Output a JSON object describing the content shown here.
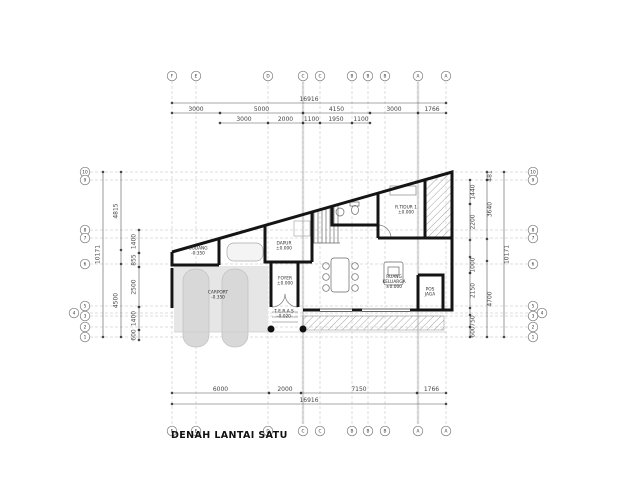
{
  "title": "DENAH LANTAI SATU",
  "colors": {
    "wall": "#141414",
    "dim": "#555555",
    "grid": "#bbbbbb",
    "axis_band": "#dcdcdc",
    "hatch": "#9a9a9a",
    "carport_fill": "#e6e6e6",
    "strip_fill": "#d8d8d8",
    "label": "#2b2b2b"
  },
  "grid": {
    "top_circle_y": 76,
    "bottom_circle_y": 431,
    "left_circle_x": 85,
    "right_circle_x": 533,
    "cols": [
      {
        "label": "F",
        "x": 172
      },
      {
        "label": "E",
        "x": 196
      },
      {
        "label": "D",
        "x": 268
      },
      {
        "label": "C",
        "x": 303
      },
      {
        "label": "C",
        "x": 320
      },
      {
        "label": "B",
        "x": 352
      },
      {
        "label": "B",
        "x": 368
      },
      {
        "label": "B",
        "x": 385
      },
      {
        "label": "A",
        "x": 418
      },
      {
        "label": "A",
        "x": 446
      }
    ],
    "rows": [
      {
        "label": "10",
        "y": 172
      },
      {
        "label": "9",
        "y": 180
      },
      {
        "label": "8",
        "y": 230
      },
      {
        "label": "7",
        "y": 238
      },
      {
        "label": "6",
        "y": 264
      },
      {
        "label": "5",
        "y": 306
      },
      {
        "label": "4",
        "y": 313,
        "lx": 74,
        "rx": 542
      },
      {
        "label": "3",
        "y": 316
      },
      {
        "label": "2",
        "y": 327
      },
      {
        "label": "1",
        "y": 337
      }
    ]
  },
  "dims_h": [
    {
      "y": 103,
      "segs": [
        {
          "a": 172,
          "b": 446,
          "t": "16916"
        }
      ]
    },
    {
      "y": 113,
      "segs": [
        {
          "a": 172,
          "b": 220,
          "t": "3000"
        },
        {
          "a": 220,
          "b": 303,
          "t": "5000"
        },
        {
          "a": 303,
          "b": 370,
          "t": "4150"
        },
        {
          "a": 370,
          "b": 418,
          "t": "3000"
        },
        {
          "a": 418,
          "b": 446,
          "t": "1766"
        }
      ]
    },
    {
      "y": 123,
      "segs": [
        {
          "a": 220,
          "b": 268,
          "t": "3000"
        },
        {
          "a": 268,
          "b": 303,
          "t": "2000"
        },
        {
          "a": 303,
          "b": 320,
          "t": "1100"
        },
        {
          "a": 320,
          "b": 352,
          "t": "1950"
        },
        {
          "a": 352,
          "b": 370,
          "t": "1100"
        }
      ]
    },
    {
      "y": 393,
      "segs": [
        {
          "a": 172,
          "b": 269,
          "t": "6000"
        },
        {
          "a": 269,
          "b": 301,
          "t": "2000"
        },
        {
          "a": 301,
          "b": 417,
          "t": "7150"
        },
        {
          "a": 417,
          "b": 446,
          "t": "1766"
        }
      ]
    },
    {
      "y": 404,
      "segs": [
        {
          "a": 172,
          "b": 446,
          "t": "16916"
        }
      ]
    }
  ],
  "dims_v": [
    {
      "x": 103,
      "tx": -3.5,
      "segs": [
        {
          "a": 172,
          "b": 337,
          "t": "10171"
        }
      ]
    },
    {
      "x": 121,
      "tx": -3.5,
      "segs": [
        {
          "a": 172,
          "b": 250,
          "t": "4815"
        },
        {
          "a": 264,
          "b": 337,
          "t": "4500"
        }
      ]
    },
    {
      "x": 139,
      "tx": -3.5,
      "segs": [
        {
          "a": 230,
          "b": 253,
          "t": "1400"
        },
        {
          "a": 253,
          "b": 267,
          "t": "855"
        },
        {
          "a": 267,
          "b": 307,
          "t": "2500"
        },
        {
          "a": 307,
          "b": 330,
          "t": "1400"
        },
        {
          "a": 330,
          "b": 340,
          "t": "600"
        }
      ]
    },
    {
      "x": 470,
      "tx": 4.5,
      "segs": [
        {
          "a": 180,
          "b": 204,
          "t": "1440"
        },
        {
          "a": 204,
          "b": 240,
          "t": "2200"
        },
        {
          "a": 257,
          "b": 273,
          "t": "1000"
        },
        {
          "a": 273,
          "b": 308,
          "t": "2150"
        },
        {
          "a": 315,
          "b": 327,
          "t": "750"
        },
        {
          "a": 327,
          "b": 337,
          "t": "600"
        }
      ]
    },
    {
      "x": 487,
      "tx": 4.5,
      "segs": [
        {
          "a": 172,
          "b": 180,
          "t": "481"
        },
        {
          "a": 180,
          "b": 239,
          "t": "3640"
        },
        {
          "a": 261,
          "b": 337,
          "t": "4700"
        }
      ]
    },
    {
      "x": 504,
      "tx": 4.5,
      "segs": [
        {
          "a": 172,
          "b": 337,
          "t": "10171"
        }
      ]
    }
  ],
  "rooms": [
    {
      "id": "gudang",
      "cx": 198,
      "cy": 252,
      "lines": [
        "GUDANG",
        "-0.350"
      ]
    },
    {
      "id": "dapur",
      "cx": 284,
      "cy": 247,
      "lines": [
        "DAPUR",
        "±0.000"
      ]
    },
    {
      "id": "r-tidur-1",
      "cx": 406,
      "cy": 211,
      "lines": [
        "R.TIDUR 1",
        "±0.000"
      ]
    },
    {
      "id": "foyer",
      "cx": 285,
      "cy": 282,
      "lines": [
        "FOYER",
        "±0.000"
      ]
    },
    {
      "id": "ruang-keluarga",
      "cx": 394,
      "cy": 283,
      "lines": [
        "RUANG",
        "KELUARGA",
        "±0.000"
      ]
    },
    {
      "id": "pos-jaga",
      "cx": 430,
      "cy": 293,
      "lines": [
        "POS",
        "JAGA"
      ]
    },
    {
      "id": "teras",
      "cx": 284,
      "cy": 315,
      "lines": [
        "T E R A S",
        "-0.020"
      ]
    },
    {
      "id": "carport",
      "cx": 218,
      "cy": 296,
      "lines": [
        "CARPORT",
        "-0.350"
      ]
    }
  ]
}
